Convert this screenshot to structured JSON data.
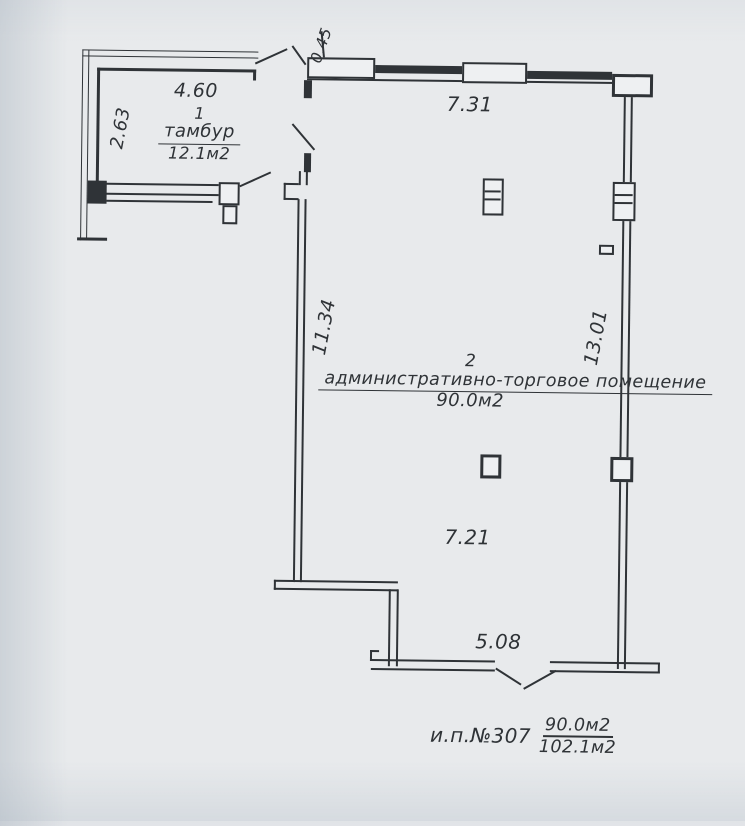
{
  "colors": {
    "ink": "#2f3337",
    "paper": "#e8eaec",
    "paperfill": "#eef0f2"
  },
  "rooms": {
    "vestibule": {
      "number": "1",
      "name": "тамбур",
      "area": "12.1м2"
    },
    "main": {
      "number": "2",
      "name": "административно-торговое помещение",
      "area": "90.0м2"
    }
  },
  "dimensions": {
    "vestibule_width": "4.60",
    "vestibule_depth": "2.63",
    "entry_offset": "0.45",
    "top_length": "7.31",
    "left_length": "11.34",
    "right_length": "13.01",
    "inner_width": "7.21",
    "bottom_width": "5.08"
  },
  "footer": {
    "unit": "и.п.№307",
    "area_numerator": "90.0м2",
    "area_denominator": "102.1м2"
  }
}
